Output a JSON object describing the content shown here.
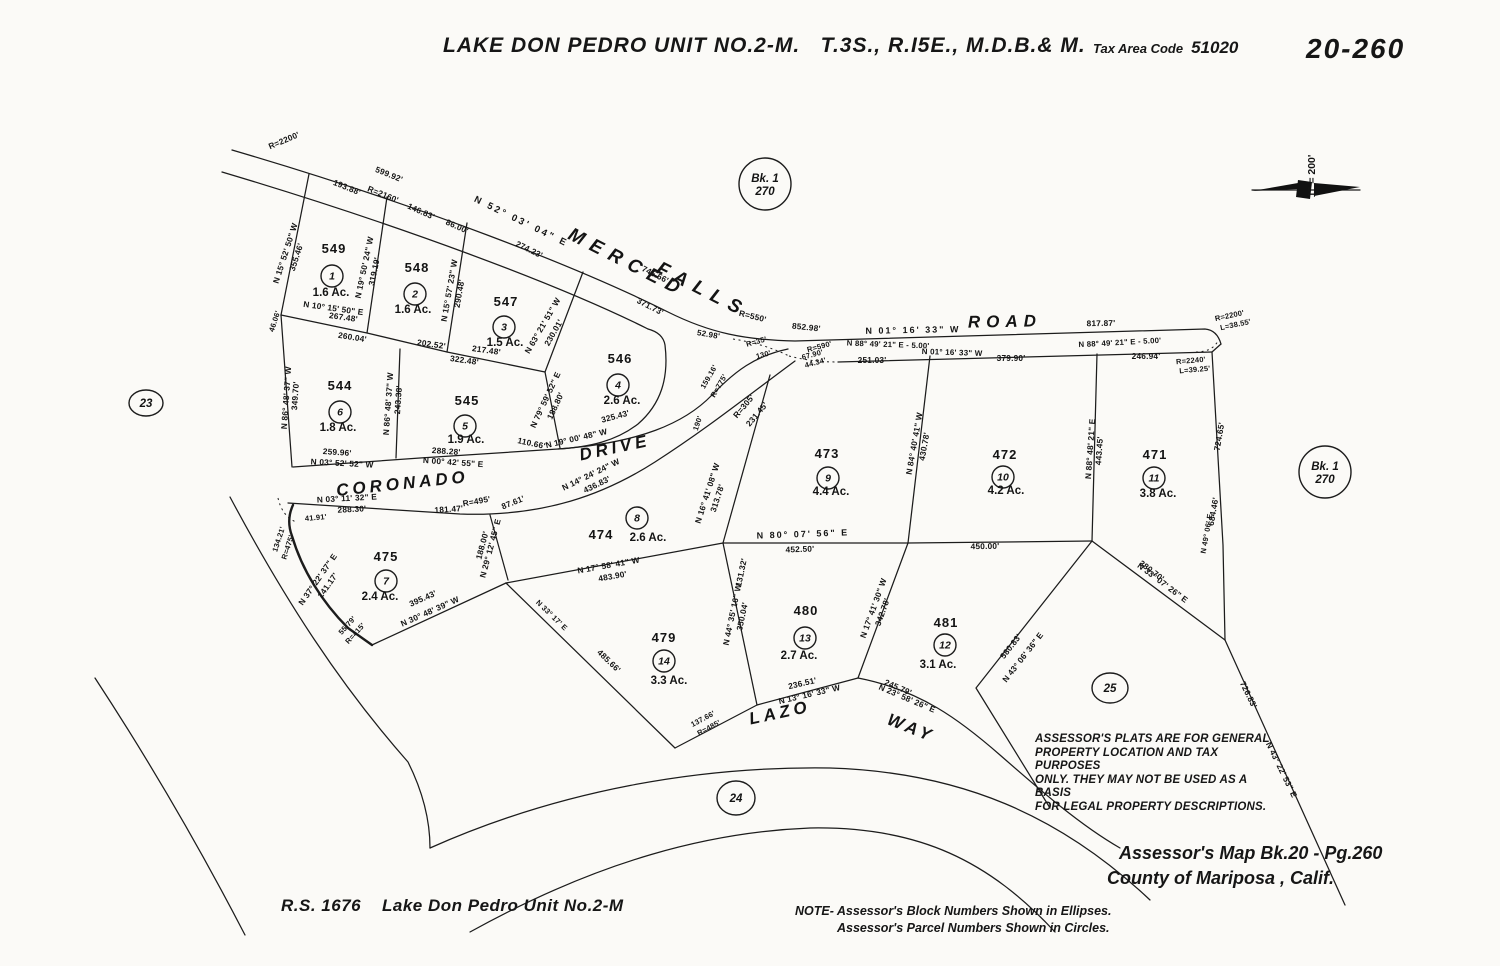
{
  "header": {
    "title": "LAKE DON PEDRO UNIT NO.2-M.   T.3S., R.I5E., M.D.B.& M.",
    "tax_area_label": "Tax Area Code",
    "tax_area_code": "51020",
    "sheet_number": "20-260"
  },
  "north_arrow": {
    "x": 1306,
    "y": 190,
    "label": "1\" = 200'"
  },
  "disclaimer": {
    "lines": [
      "ASSESSOR'S PLATS ARE FOR GENERAL",
      "PROPERTY LOCATION AND TAX PURPOSES",
      "ONLY. THEY MAY NOT BE USED AS A BASIS",
      "FOR LEGAL PROPERTY DESCRIPTIONS."
    ]
  },
  "credit": {
    "line1": "Assessor's Map Bk.20 - Pg.260",
    "line2": "County of Mariposa ,      Calif."
  },
  "footer": {
    "left": "R.S. 1676    Lake Don Pedro Unit No.2-M",
    "note1": "NOTE- Assessor's  Block Numbers  Shown in Ellipses.",
    "note2": "Assessor's  Parcel Numbers  Shown in Circles."
  },
  "map": {
    "geometry": {
      "solid": [
        "M 232 150 C 420 205 580 268 668 312 C 710 333 745 340 795 341 C 860 338 950 336 1205 329 Q 1217 330 1221 344",
        "M 222 172 C 400 225 560 285 648 329",
        "M 838 362 L 1212 352",
        "M 1221 344 L 1212 352",
        "M 293 467 L 420 458 L 558 449 C 640 443 685 423 712 395 C 735 371 755 356 788 349",
        "M 288 503 L 460 514 C 545 517 605 494 655 462 C 705 430 745 398 795 361",
        "M 648 329 Q 663 333 665 345 C 669 378 661 404 638 424 C 616 441 590 447 558 449",
        "M 309 174 L 281 315",
        "M 281 315 L 367 333 L 447 352 L 545 372",
        "M 387 197 L 367 333",
        "M 467 223 L 447 352",
        "M 583 272 L 545 372",
        "M 281 315 L 292 467",
        "M 400 349 L 396 458",
        "M 545 372 L 560 448",
        "M 490 515 L 508 580",
        "M 506 583 L 723 543",
        "M 770 375 L 723 543",
        "M 506 583 L 675 748",
        "M 372 645 L 506 583",
        "M 723 543 L 757 705",
        "M 723 543 L 908 543 L 1092 541",
        "M 930 356 L 908 543",
        "M 1097 354 L 1092 541",
        "M 1212 352 L 1223 545 L 1225 640",
        "M 1092 541 L 1225 640",
        "M 908 543 L 858 678",
        "M 1092 541 L 976 688 L 1050 808",
        "M 1225 640 L 1345 905",
        "M 675 748 L 757 705 L 858 678 C 920 690 960 720 1000 755 C 1040 790 1080 825 1120 848",
        "M 430 848 C 560 790 700 766 830 768 C 960 772 1060 815 1150 900",
        "M 470 932 C 600 860 710 832 810 828 C 920 826 990 862 1055 932",
        "M 230 497 C 285 600 340 685 408 762 C 422 790 430 818 430 848",
        "M 95 678 C 150 762 200 848 245 935"
      ],
      "bold": [
        "M 293 505 Q 286 520 292 536 C 302 570 322 602 348 628 L 372 645"
      ],
      "dotted": [
        "M 733 339 Q 765 344 789 356",
        "M 789 356 Q 812 362 838 362",
        "M 1196 352 Q 1212 352 1218 341",
        "M 278 498 Q 282 516 296 522"
      ]
    },
    "road_names": [
      {
        "t": "MERCED",
        "x": 625,
        "y": 268,
        "r": 27,
        "fs": 19,
        "ls": 8
      },
      {
        "t": "FALLS",
        "x": 700,
        "y": 295,
        "r": 27,
        "fs": 19,
        "ls": 8
      },
      {
        "t": "ROAD",
        "x": 1005,
        "y": 327,
        "r": -1,
        "fs": 17,
        "ls": 6
      },
      {
        "t": "CORONADO",
        "x": 403,
        "y": 489,
        "r": -6,
        "fs": 17,
        "ls": 4
      },
      {
        "t": "DRIVE",
        "x": 616,
        "y": 453,
        "r": -12,
        "fs": 17,
        "ls": 4
      },
      {
        "t": "LAZO",
        "x": 781,
        "y": 718,
        "r": -12,
        "fs": 17,
        "ls": 4
      },
      {
        "t": "WAY",
        "x": 909,
        "y": 733,
        "r": 22,
        "fs": 17,
        "ls": 4
      }
    ],
    "parcels": [
      {
        "apn": "549",
        "ax": 334,
        "ay": 253,
        "n": "1",
        "cx": 332,
        "cy": 276,
        "ac": "1.6 Ac.",
        "gx": 331,
        "gy": 296
      },
      {
        "apn": "548",
        "ax": 417,
        "ay": 272,
        "n": "2",
        "cx": 415,
        "cy": 294,
        "ac": "1.6 Ac.",
        "gx": 413,
        "gy": 313
      },
      {
        "apn": "547",
        "ax": 506,
        "ay": 306,
        "n": "3",
        "cx": 504,
        "cy": 327,
        "ac": "1.5 Ac.",
        "gx": 505,
        "gy": 346
      },
      {
        "apn": "546",
        "ax": 620,
        "ay": 363,
        "n": "4",
        "cx": 618,
        "cy": 385,
        "ac": "2.6 Ac.",
        "gx": 622,
        "gy": 404
      },
      {
        "apn": "545",
        "ax": 467,
        "ay": 405,
        "n": "5",
        "cx": 465,
        "cy": 426,
        "ac": "1.9 Ac.",
        "gx": 466,
        "gy": 443
      },
      {
        "apn": "544",
        "ax": 340,
        "ay": 390,
        "n": "6",
        "cx": 340,
        "cy": 412,
        "ac": "1.8 Ac.",
        "gx": 338,
        "gy": 431
      },
      {
        "apn": "475",
        "ax": 386,
        "ay": 561,
        "n": "7",
        "cx": 386,
        "cy": 581,
        "ac": "2.4 Ac.",
        "gx": 380,
        "gy": 600
      },
      {
        "apn": "474",
        "ax": 601,
        "ay": 539,
        "n": "8",
        "cx": 637,
        "cy": 518,
        "ac": "2.6 Ac.",
        "gx": 648,
        "gy": 541
      },
      {
        "apn": "473",
        "ax": 827,
        "ay": 458,
        "n": "9",
        "cx": 828,
        "cy": 478,
        "ac": "4.4 Ac.",
        "gx": 831,
        "gy": 495
      },
      {
        "apn": "472",
        "ax": 1005,
        "ay": 459,
        "n": "10",
        "cx": 1003,
        "cy": 477,
        "ac": "4.2 Ac.",
        "gx": 1006,
        "gy": 494
      },
      {
        "apn": "471",
        "ax": 1155,
        "ay": 459,
        "n": "11",
        "cx": 1154,
        "cy": 478,
        "ac": "3.8 Ac.",
        "gx": 1158,
        "gy": 497
      },
      {
        "apn": "481",
        "ax": 946,
        "ay": 627,
        "n": "12",
        "cx": 945,
        "cy": 645,
        "ac": "3.1 Ac.",
        "gx": 938,
        "gy": 668
      },
      {
        "apn": "480",
        "ax": 806,
        "ay": 615,
        "n": "13",
        "cx": 805,
        "cy": 638,
        "ac": "2.7 Ac.",
        "gx": 799,
        "gy": 659
      },
      {
        "apn": "479",
        "ax": 664,
        "ay": 642,
        "n": "14",
        "cx": 664,
        "cy": 661,
        "ac": "3.3 Ac.",
        "gx": 669,
        "gy": 684
      }
    ],
    "blocks": [
      {
        "lines": [
          "Bk. 1",
          "270"
        ],
        "x": 765,
        "y": 184,
        "rx": 26,
        "ry": 26
      },
      {
        "lines": [
          "Bk. 1",
          "270"
        ],
        "x": 1325,
        "y": 472,
        "rx": 26,
        "ry": 26
      },
      {
        "lines": [
          "23"
        ],
        "x": 146,
        "y": 403,
        "rx": 17,
        "ry": 13
      },
      {
        "lines": [
          "24"
        ],
        "x": 736,
        "y": 798,
        "rx": 19,
        "ry": 17
      },
      {
        "lines": [
          "25"
        ],
        "x": 1110,
        "y": 688,
        "rx": 18,
        "ry": 15
      }
    ],
    "dims": [
      {
        "t": "R=2200'",
        "x": 285,
        "y": 143,
        "r": -23
      },
      {
        "t": "599.92'",
        "x": 388,
        "y": 177,
        "r": 22
      },
      {
        "t": "193.88'",
        "x": 346,
        "y": 190,
        "r": 22
      },
      {
        "t": "R=2160'",
        "x": 382,
        "y": 197,
        "r": 22
      },
      {
        "t": "146.83'",
        "x": 420,
        "y": 214,
        "r": 24
      },
      {
        "t": "86.00'",
        "x": 456,
        "y": 229,
        "r": 24
      },
      {
        "t": "N 52° 03' 04\" E",
        "x": 520,
        "y": 224,
        "r": 26,
        "fs": 9.5,
        "ls": 2.5
      },
      {
        "t": "274.23'",
        "x": 528,
        "y": 252,
        "r": 26
      },
      {
        "t": "745.56'",
        "x": 654,
        "y": 277,
        "r": 27
      },
      {
        "t": "371.73'",
        "x": 649,
        "y": 309,
        "r": 27
      },
      {
        "t": "R=550'",
        "x": 752,
        "y": 319,
        "r": 14
      },
      {
        "t": "852.98'",
        "x": 806,
        "y": 330,
        "r": 6
      },
      {
        "t": "N 01° 16' 33\" W",
        "x": 913,
        "y": 333,
        "r": -1,
        "fs": 9,
        "ls": 2
      },
      {
        "t": "817.87'",
        "x": 1101,
        "y": 326,
        "r": -1
      },
      {
        "t": "R=2200'",
        "x": 1230,
        "y": 318,
        "r": -12,
        "fs": 7.5
      },
      {
        "t": "L=38.55'",
        "x": 1236,
        "y": 327,
        "r": -12,
        "fs": 7.5
      },
      {
        "t": "N 88° 49' 21\" E - 5.00'",
        "x": 888,
        "y": 347,
        "r": 2,
        "fs": 7.8
      },
      {
        "t": "N 01° 16' 33\" W",
        "x": 952,
        "y": 355,
        "r": 2,
        "fs": 8
      },
      {
        "t": "251.03'",
        "x": 872,
        "y": 363,
        "r": 0
      },
      {
        "t": "379.90'",
        "x": 1011,
        "y": 361,
        "r": 0
      },
      {
        "t": "N 88° 49' 21\" E - 5.00'",
        "x": 1120,
        "y": 345,
        "r": -3,
        "fs": 7.8
      },
      {
        "t": "246.94'",
        "x": 1146,
        "y": 359,
        "r": 0
      },
      {
        "t": "R=2240'",
        "x": 1191,
        "y": 363,
        "r": -5,
        "fs": 7.5
      },
      {
        "t": "L=39.25'",
        "x": 1195,
        "y": 372,
        "r": -5,
        "fs": 7.5
      },
      {
        "t": "R=590'",
        "x": 820,
        "y": 349,
        "r": -15,
        "fs": 7.5
      },
      {
        "t": "67.90'",
        "x": 813,
        "y": 357,
        "r": -15,
        "fs": 7.5
      },
      {
        "t": "44.34'",
        "x": 816,
        "y": 365,
        "r": -15,
        "fs": 7.5
      },
      {
        "t": "R=35'",
        "x": 757,
        "y": 344,
        "r": -15,
        "fs": 7.5
      },
      {
        "t": "130'",
        "x": 764,
        "y": 357,
        "r": -15,
        "fs": 7.5
      },
      {
        "t": "52.98'",
        "x": 708,
        "y": 337,
        "r": 10,
        "fs": 8
      },
      {
        "t": "159.16'",
        "x": 711,
        "y": 378,
        "r": -60,
        "fs": 7.5
      },
      {
        "t": "R=775'",
        "x": 721,
        "y": 387,
        "r": -60,
        "fs": 7.5
      },
      {
        "t": "R=305'",
        "x": 746,
        "y": 408,
        "r": -50
      },
      {
        "t": "231.45'",
        "x": 759,
        "y": 416,
        "r": -50
      },
      {
        "t": "190'",
        "x": 700,
        "y": 424,
        "r": -72,
        "fs": 7.5
      },
      {
        "t": "N 15° 52' 50\" W",
        "x": 288,
        "y": 254,
        "r": -72
      },
      {
        "t": "355.46'",
        "x": 299,
        "y": 258,
        "r": -72
      },
      {
        "t": "N 19° 50' 24\" W",
        "x": 367,
        "y": 268,
        "r": -78
      },
      {
        "t": "319.19'",
        "x": 377,
        "y": 272,
        "r": -78
      },
      {
        "t": "N 15° 57' 23\" W",
        "x": 452,
        "y": 291,
        "r": -80
      },
      {
        "t": "290.48'",
        "x": 462,
        "y": 294,
        "r": -80
      },
      {
        "t": "N 63° 21' 51\" W",
        "x": 545,
        "y": 327,
        "r": -60
      },
      {
        "t": "230.01'",
        "x": 556,
        "y": 334,
        "r": -60
      },
      {
        "t": "N 10° 15' 50\" E",
        "x": 333,
        "y": 311,
        "r": 8
      },
      {
        "t": "267.48'",
        "x": 343,
        "y": 320,
        "r": 8
      },
      {
        "t": "46.06'",
        "x": 277,
        "y": 322,
        "r": -72,
        "fs": 7.5
      },
      {
        "t": "260.04'",
        "x": 352,
        "y": 340,
        "r": 9
      },
      {
        "t": "202.52'",
        "x": 431,
        "y": 347,
        "r": 8
      },
      {
        "t": "217.48'",
        "x": 486,
        "y": 353,
        "r": 8
      },
      {
        "t": "322.48'",
        "x": 464,
        "y": 363,
        "r": 8
      },
      {
        "t": "N 86° 48' 37\" W",
        "x": 289,
        "y": 398,
        "r": -86
      },
      {
        "t": "349.70'",
        "x": 298,
        "y": 396,
        "r": -86
      },
      {
        "t": "N 86° 48' 37\" W",
        "x": 391,
        "y": 404,
        "r": -86
      },
      {
        "t": "243.38'",
        "x": 401,
        "y": 400,
        "r": -86
      },
      {
        "t": "N 79° 59' 52\" E",
        "x": 548,
        "y": 401,
        "r": -65
      },
      {
        "t": "188.80'",
        "x": 558,
        "y": 407,
        "r": -65
      },
      {
        "t": "259.96'",
        "x": 337,
        "y": 455,
        "r": 4
      },
      {
        "t": "N 03° 52' 52\" W",
        "x": 342,
        "y": 466,
        "r": 3
      },
      {
        "t": "288.28'",
        "x": 446,
        "y": 454,
        "r": 4
      },
      {
        "t": "N 00° 42' 55\" E",
        "x": 453,
        "y": 465,
        "r": 4
      },
      {
        "t": "110.66'",
        "x": 531,
        "y": 446,
        "r": 12
      },
      {
        "t": "N 19° 00' 48\" W",
        "x": 577,
        "y": 441,
        "r": -13
      },
      {
        "t": "325.43'",
        "x": 616,
        "y": 419,
        "r": -15
      },
      {
        "t": "N 03° 11' 32\" E",
        "x": 347,
        "y": 501,
        "r": -3
      },
      {
        "t": "288.30'",
        "x": 352,
        "y": 512,
        "r": -3
      },
      {
        "t": "181.47'",
        "x": 449,
        "y": 512,
        "r": -4
      },
      {
        "t": "R=495'",
        "x": 477,
        "y": 504,
        "r": -10
      },
      {
        "t": "87.61'",
        "x": 514,
        "y": 505,
        "r": -22
      },
      {
        "t": "N 14° 24' 24\" W",
        "x": 592,
        "y": 477,
        "r": -26
      },
      {
        "t": "436.83'",
        "x": 598,
        "y": 487,
        "r": -26
      },
      {
        "t": "41.91'",
        "x": 316,
        "y": 520,
        "r": -5,
        "fs": 7.5
      },
      {
        "t": "134.21'",
        "x": 281,
        "y": 540,
        "r": -72,
        "fs": 7.5
      },
      {
        "t": "R=475'",
        "x": 290,
        "y": 548,
        "r": -72,
        "fs": 7.5
      },
      {
        "t": "N 37° 22' 37\" E",
        "x": 320,
        "y": 581,
        "r": -55
      },
      {
        "t": "141.17'",
        "x": 330,
        "y": 587,
        "r": -55
      },
      {
        "t": "55.79'",
        "x": 349,
        "y": 627,
        "r": -48,
        "fs": 7.5
      },
      {
        "t": "R=415'",
        "x": 357,
        "y": 635,
        "r": -48,
        "fs": 7.5
      },
      {
        "t": "395.43'",
        "x": 424,
        "y": 601,
        "r": -24
      },
      {
        "t": "N 30° 48' 39\" W",
        "x": 431,
        "y": 614,
        "r": -24
      },
      {
        "t": "N 29° 12' 45\" E",
        "x": 493,
        "y": 549,
        "r": -75
      },
      {
        "t": "188.00'",
        "x": 485,
        "y": 546,
        "r": -75
      },
      {
        "t": "N 16° 41' 08\" W",
        "x": 710,
        "y": 494,
        "r": -72
      },
      {
        "t": "313.78'",
        "x": 720,
        "y": 499,
        "r": -72
      },
      {
        "t": "131.32'",
        "x": 744,
        "y": 573,
        "r": -78
      },
      {
        "t": "N 17° 58' 41\" W",
        "x": 609,
        "y": 568,
        "r": -10
      },
      {
        "t": "483.90'",
        "x": 613,
        "y": 579,
        "r": -10
      },
      {
        "t": "N 80° 07' 56\" E",
        "x": 803,
        "y": 537,
        "r": -2,
        "fs": 9,
        "ls": 2
      },
      {
        "t": "452.50'",
        "x": 800,
        "y": 552,
        "r": -2
      },
      {
        "t": "450.00'",
        "x": 985,
        "y": 549,
        "r": -1
      },
      {
        "t": "N 84° 40' 41\" W",
        "x": 917,
        "y": 444,
        "r": -80
      },
      {
        "t": "430.78'",
        "x": 927,
        "y": 447,
        "r": -80
      },
      {
        "t": "N 88° 48' 21\" E",
        "x": 1093,
        "y": 449,
        "r": -86
      },
      {
        "t": "443.45'",
        "x": 1102,
        "y": 451,
        "r": -86
      },
      {
        "t": "724.65'",
        "x": 1222,
        "y": 437,
        "r": -80
      },
      {
        "t": "684.46'",
        "x": 1216,
        "y": 512,
        "r": -80
      },
      {
        "t": "N 49° 06' E",
        "x": 1209,
        "y": 534,
        "r": -80,
        "fs": 7.5
      },
      {
        "t": "380.70'",
        "x": 1150,
        "y": 573,
        "r": 37
      },
      {
        "t": "N 33° 07' 26\" E",
        "x": 1161,
        "y": 585,
        "r": 37
      },
      {
        "t": "N 44° 35' 16\" W",
        "x": 735,
        "y": 615,
        "r": -78
      },
      {
        "t": "350.04'",
        "x": 745,
        "y": 617,
        "r": -78
      },
      {
        "t": "N 17° 41' 30\" W",
        "x": 876,
        "y": 609,
        "r": -70
      },
      {
        "t": "342.78'",
        "x": 885,
        "y": 613,
        "r": -70
      },
      {
        "t": "485.66'",
        "x": 607,
        "y": 663,
        "r": 44
      },
      {
        "t": "N 33° 17' E",
        "x": 550,
        "y": 617,
        "r": 44,
        "fs": 7.5
      },
      {
        "t": "236.51'",
        "x": 803,
        "y": 686,
        "r": -13
      },
      {
        "t": "N 13° 16' 33\" W",
        "x": 810,
        "y": 697,
        "r": -13
      },
      {
        "t": "137.66'",
        "x": 704,
        "y": 721,
        "r": -28,
        "fs": 7.5
      },
      {
        "t": "R=485'",
        "x": 710,
        "y": 730,
        "r": -28,
        "fs": 7.5
      },
      {
        "t": "245.79'",
        "x": 897,
        "y": 690,
        "r": 23
      },
      {
        "t": "N 23° 58' 26\" E",
        "x": 906,
        "y": 701,
        "r": 23
      },
      {
        "t": "580.83'",
        "x": 1013,
        "y": 648,
        "r": -52
      },
      {
        "t": "N 43° 06' 36\" E",
        "x": 1025,
        "y": 659,
        "r": -52
      },
      {
        "t": "726.83'",
        "x": 1246,
        "y": 696,
        "r": 64
      },
      {
        "t": "N 43° 22' 53\" E",
        "x": 1279,
        "y": 771,
        "r": 64
      }
    ]
  }
}
